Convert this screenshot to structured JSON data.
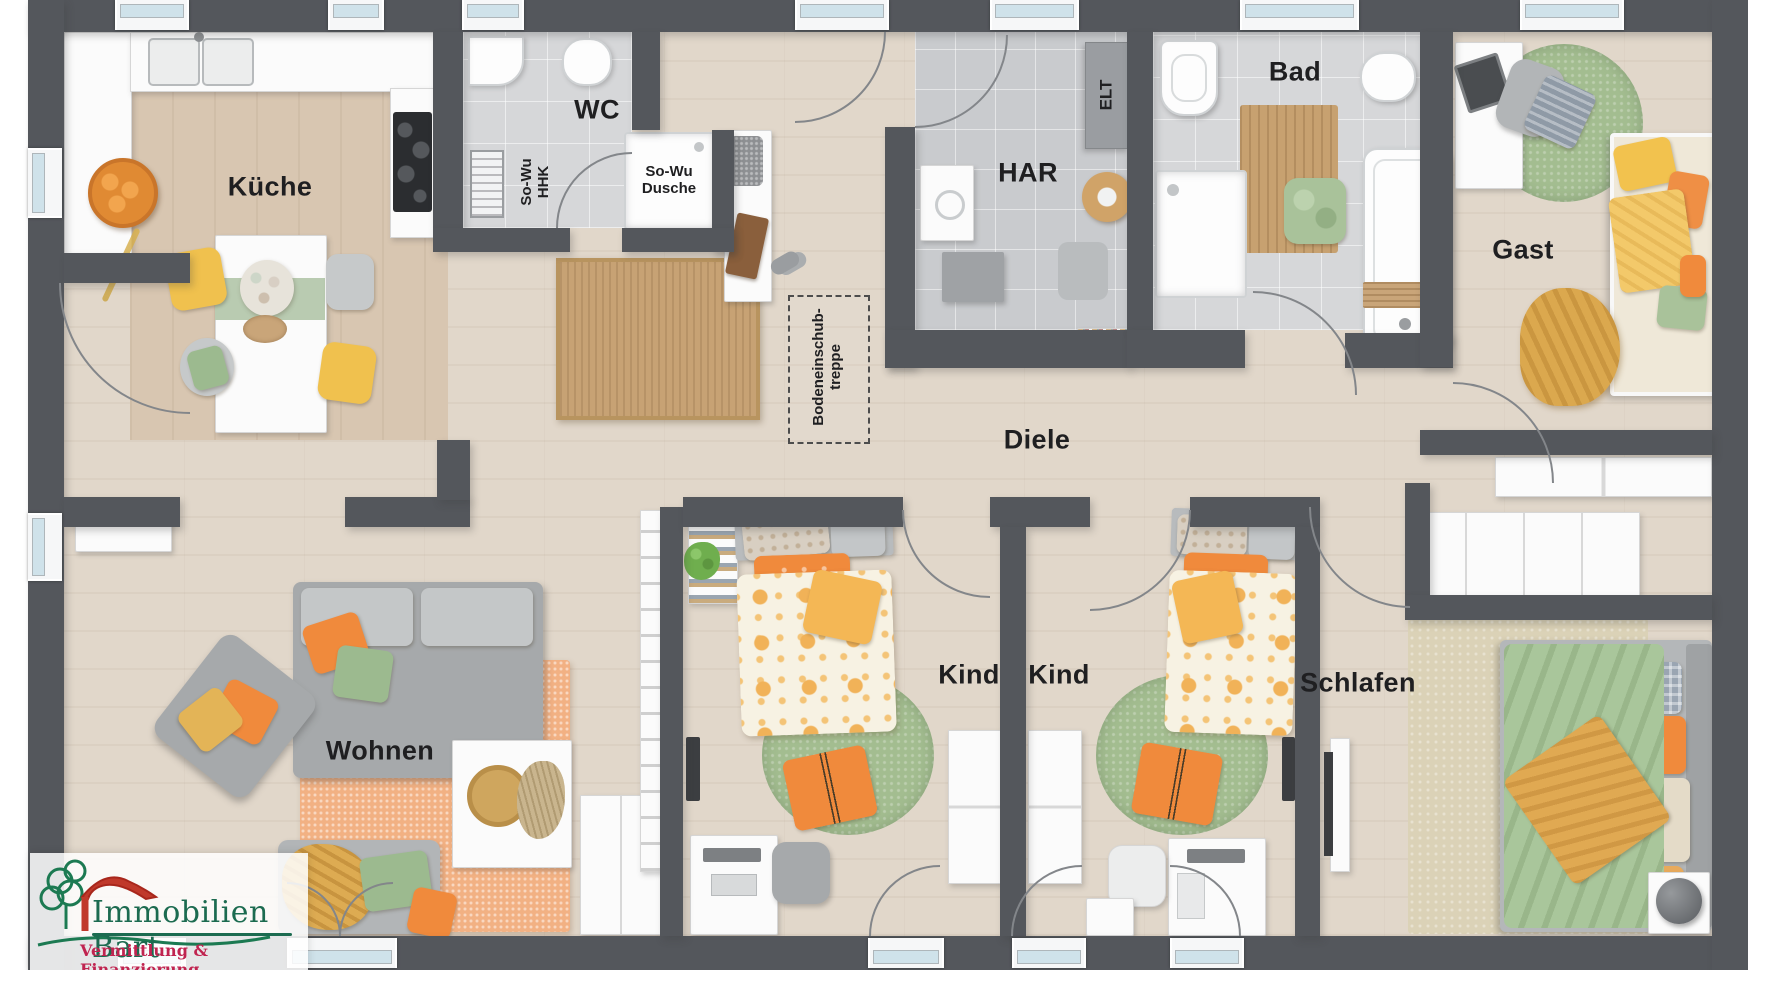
{
  "plan": {
    "rooms": {
      "kueche": "Küche",
      "wc": "WC",
      "har": "HAR",
      "bad": "Bad",
      "gast": "Gast",
      "diele": "Diele",
      "wohnen": "Wohnen",
      "kind1": "Kind",
      "kind2": "Kind",
      "schlafen": "Schlafen"
    },
    "annotations": {
      "sowu_hhk_l1": "So-Wu",
      "sowu_hhk_l2": "HHK",
      "sowu_dusche_l1": "So-Wu",
      "sowu_dusche_l2": "Dusche",
      "elt": "ELT",
      "treppe_l1": "Bodeneinschub-",
      "treppe_l2": "treppe"
    },
    "logo": {
      "name": "Immobilien Bart",
      "tagline": "Vermittlung & Finanzierung"
    },
    "colors": {
      "wall": "#54575c",
      "wood_floor": "#e1d7ca",
      "kitchen_floor": "#d8c6b1",
      "tile_floor": "#d6d7d9",
      "accent_orange": "#f08a3c",
      "accent_yellow": "#f2c24e",
      "accent_green": "#a3bd90",
      "window_glass": "#cfe2ea",
      "logo_green": "#1c6b50",
      "logo_red": "#c02450"
    }
  }
}
